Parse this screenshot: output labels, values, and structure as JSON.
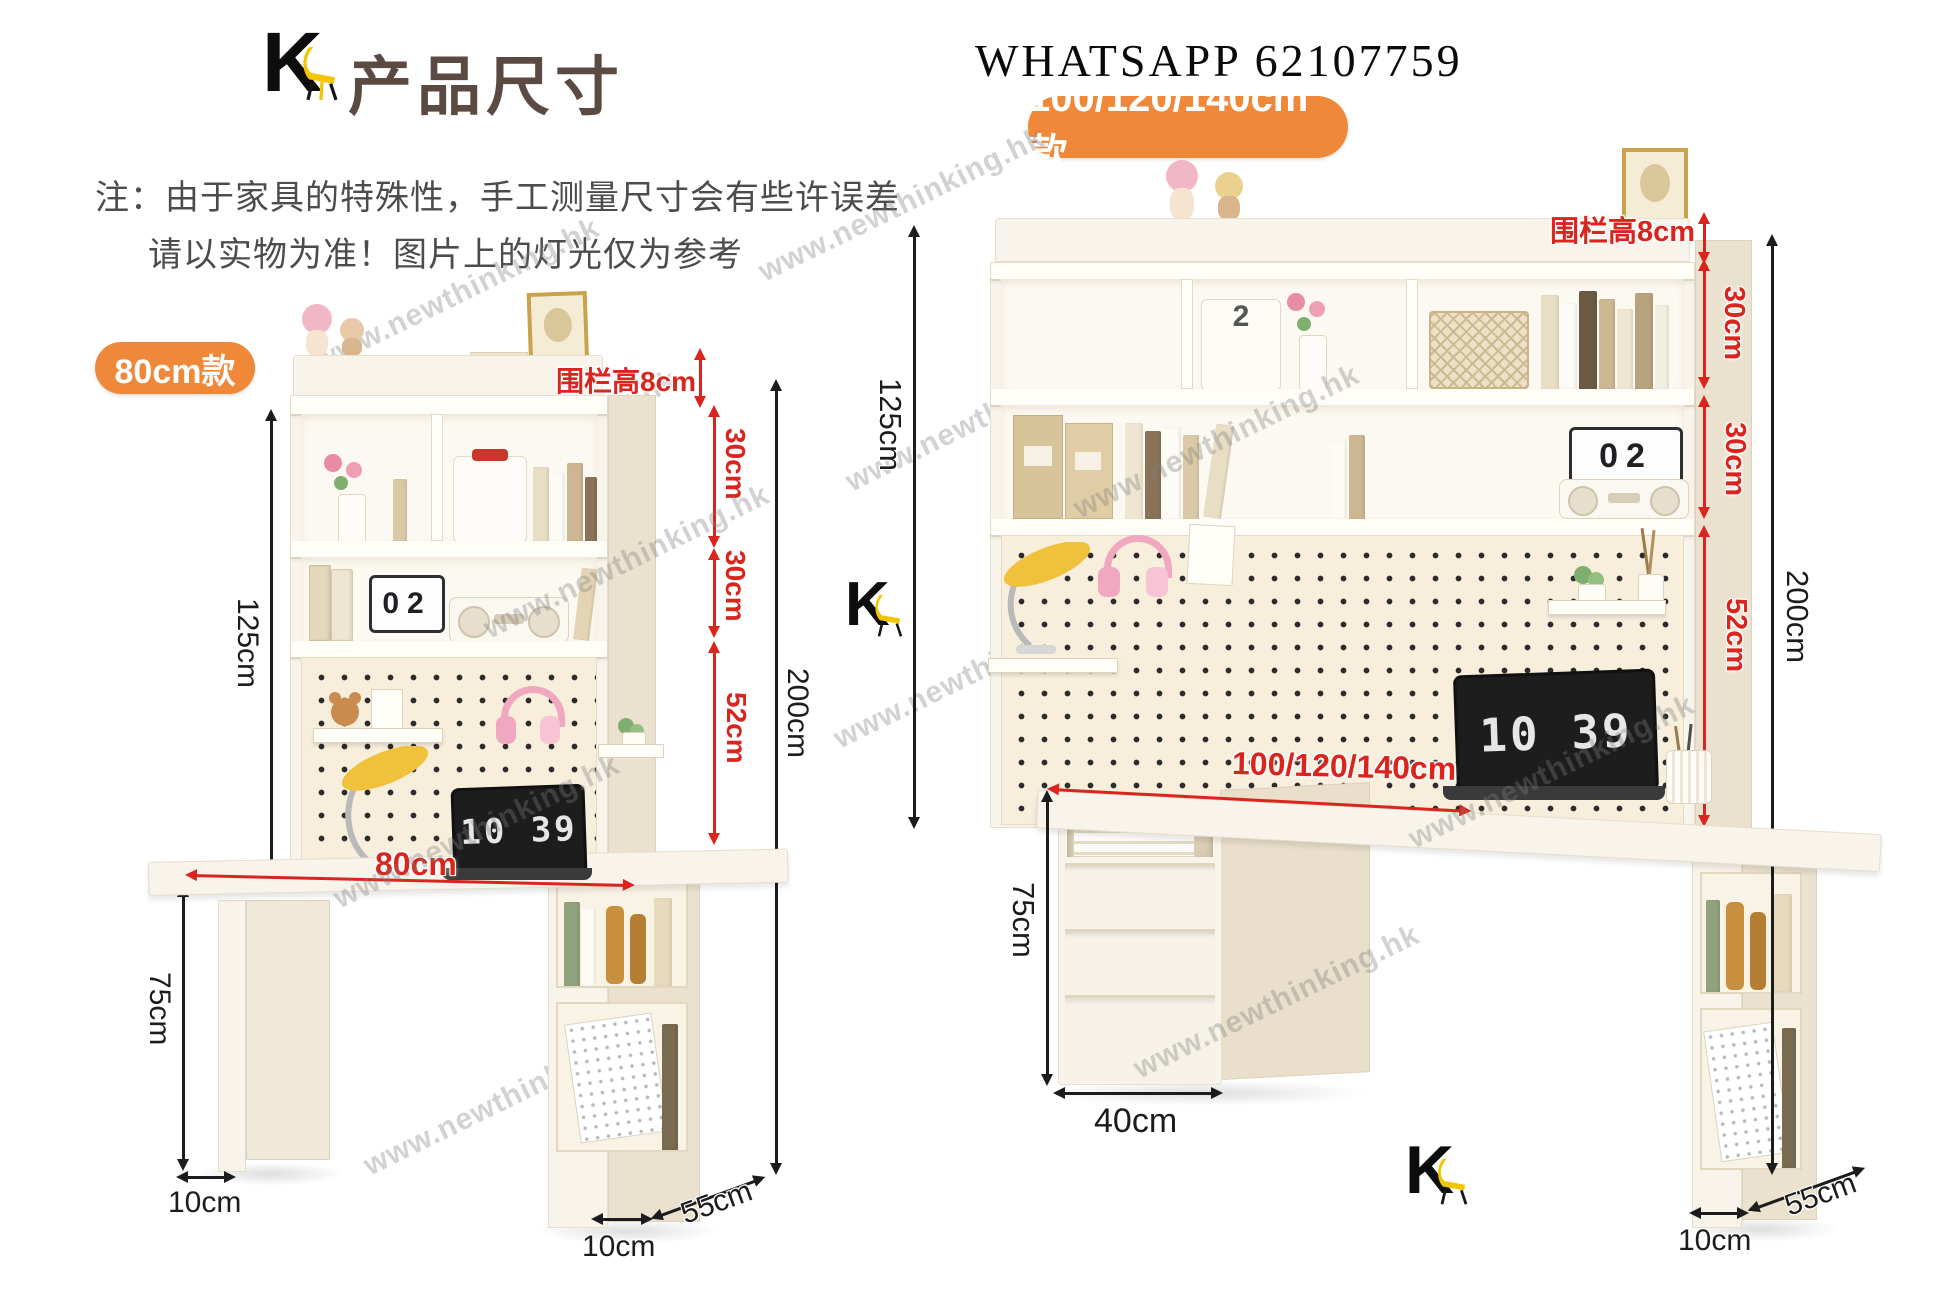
{
  "page": {
    "logo_letter": "K",
    "title": "产品尺寸",
    "whatsapp": "WHATSAPP 62107759",
    "note_line1": "注：由于家具的特殊性，手工测量尺寸会有些许误差",
    "note_line2": "请以实物为准！图片上的灯光仅为参考",
    "watermark": "www.newthinking.hk"
  },
  "left_desk": {
    "badge": "80cm款",
    "fence_label": "围栏高8cm",
    "shelf1": "30cm",
    "shelf2": "30cm",
    "pegboard_height": "52cm",
    "hutch_height": "125cm",
    "total_height": "200cm",
    "desk_width": "80cm",
    "desk_height": "75cm",
    "leg_depth": "10cm",
    "base_depth_front": "10cm",
    "base_depth_side": "55cm",
    "laptop_time": "10 39",
    "calendar_day": "02"
  },
  "right_desk": {
    "badge": "100/120/140cm款",
    "fence_label": "围栏高8cm",
    "shelf1": "30cm",
    "shelf2": "30cm",
    "pegboard_height": "52cm",
    "hutch_height": "125cm",
    "total_height": "200cm",
    "desk_width": "100/120/140cm",
    "desk_height": "75cm",
    "drawer_width": "40cm",
    "base_depth_front": "10cm",
    "base_depth_side": "55cm",
    "laptop_time": "10 39",
    "calendar_day": "02",
    "box_number": "2"
  }
}
